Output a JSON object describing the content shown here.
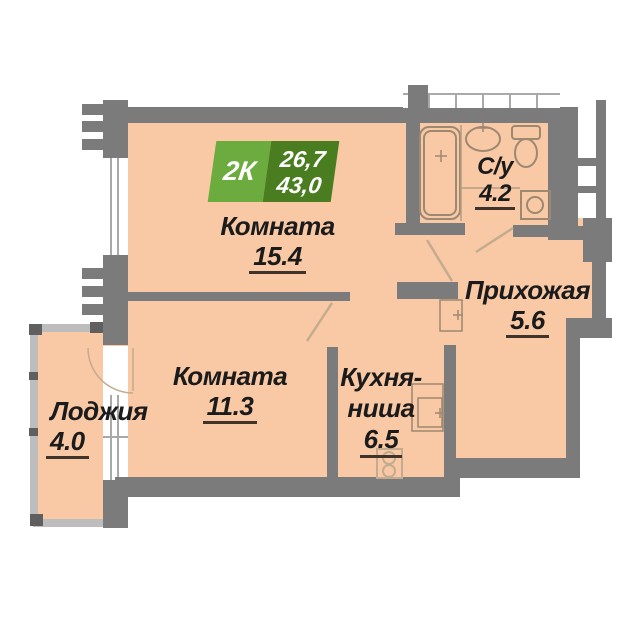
{
  "title_badge": {
    "type": "2К",
    "area_living": "26,7",
    "area_total": "43,0"
  },
  "rooms": [
    {
      "name": "Комната",
      "area": "15.4"
    },
    {
      "name": "Комната",
      "area": "11.3"
    },
    {
      "name_line1": "Кухня-",
      "name_line2": "ниша",
      "area": "6.5"
    },
    {
      "name": "Прихожая",
      "area": "5.6"
    },
    {
      "name": "С/у",
      "area": "4.2"
    },
    {
      "name": "Лоджия",
      "area": "4.0"
    }
  ],
  "colors": {
    "floor": "#F8C9A4",
    "wall": "#7B7B7B",
    "badge_light": "#6CAB3E",
    "badge_dark": "#497D20",
    "line": "#9D8872",
    "underline": "#3F332A",
    "text": "#1B1B1B"
  }
}
